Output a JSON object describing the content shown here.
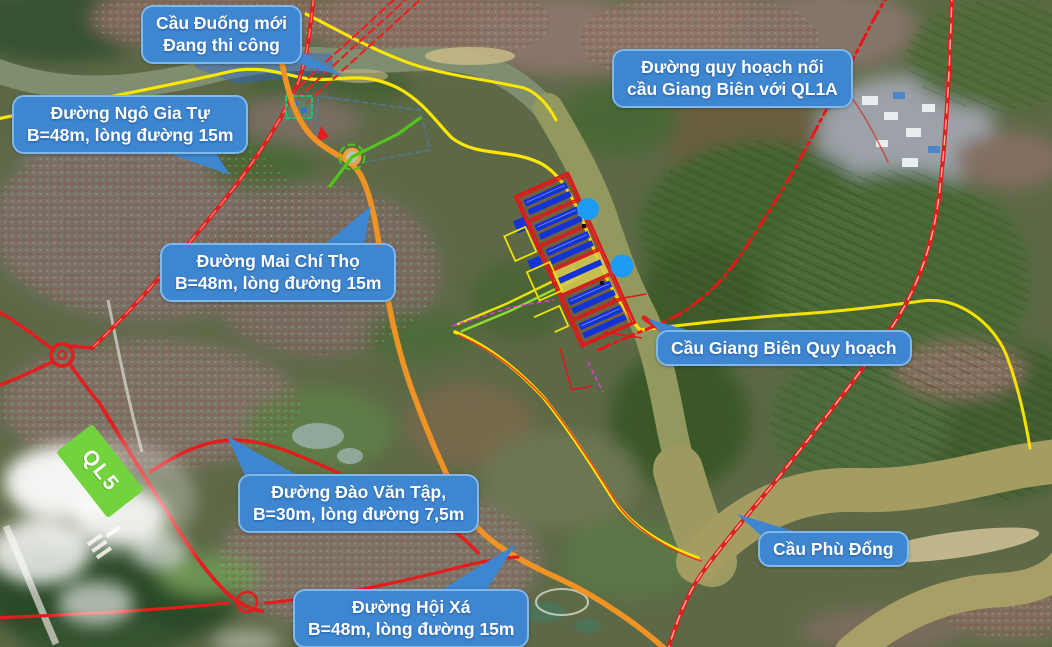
{
  "title": "Annotated satellite planning map – Long Biên / Gia Lâm area",
  "callouts": {
    "cau_duong_moi": {
      "lines": [
        "Cầu Đuống mới",
        "Đang thi công"
      ]
    },
    "quy_hoach_noi": {
      "lines": [
        "Đường quy hoạch nối",
        "cầu Giang Biên với QL1A"
      ]
    },
    "ngo_gia_tu": {
      "lines": [
        "Đường Ngô Gia Tự",
        "B=48m, lòng đường 15m"
      ]
    },
    "mai_chi_tho": {
      "lines": [
        "Đường Mai Chí Thọ",
        "B=48m, lòng đường 15m"
      ]
    },
    "giang_bien": {
      "lines": [
        "Cầu Giang Biên Quy hoạch"
      ]
    },
    "dao_van_tap": {
      "lines": [
        "Đường Đào Văn Tập,",
        "B=30m, lòng đường 7,5m"
      ]
    },
    "phu_dong": {
      "lines": [
        "Cầu Phù Đổng"
      ]
    },
    "hoi_xa": {
      "lines": [
        "Đường Hội Xá",
        "B=48m, lòng đường 15m"
      ]
    }
  },
  "badges": {
    "ql5": "QL5"
  },
  "colors": {
    "callout_bg": "#3E86D0",
    "callout_border": "#7FB9EC",
    "callout_text": "#FFFFFF",
    "ql5_bg": "#72D33C",
    "road_red": "#E21D1D",
    "road_orange": "#EF9424",
    "road_green": "#52C41A",
    "boundary_yellow": "#FFE800",
    "planned_road_red": "#E81616",
    "zone_outline_red": "#E01818",
    "zone_building_blue": "#1433D6",
    "zone_yellow": "#F0E000",
    "circle_blue": "#1E9BF5",
    "river_upper": "#7F8E6E",
    "river_lower": "#A59C62"
  }
}
